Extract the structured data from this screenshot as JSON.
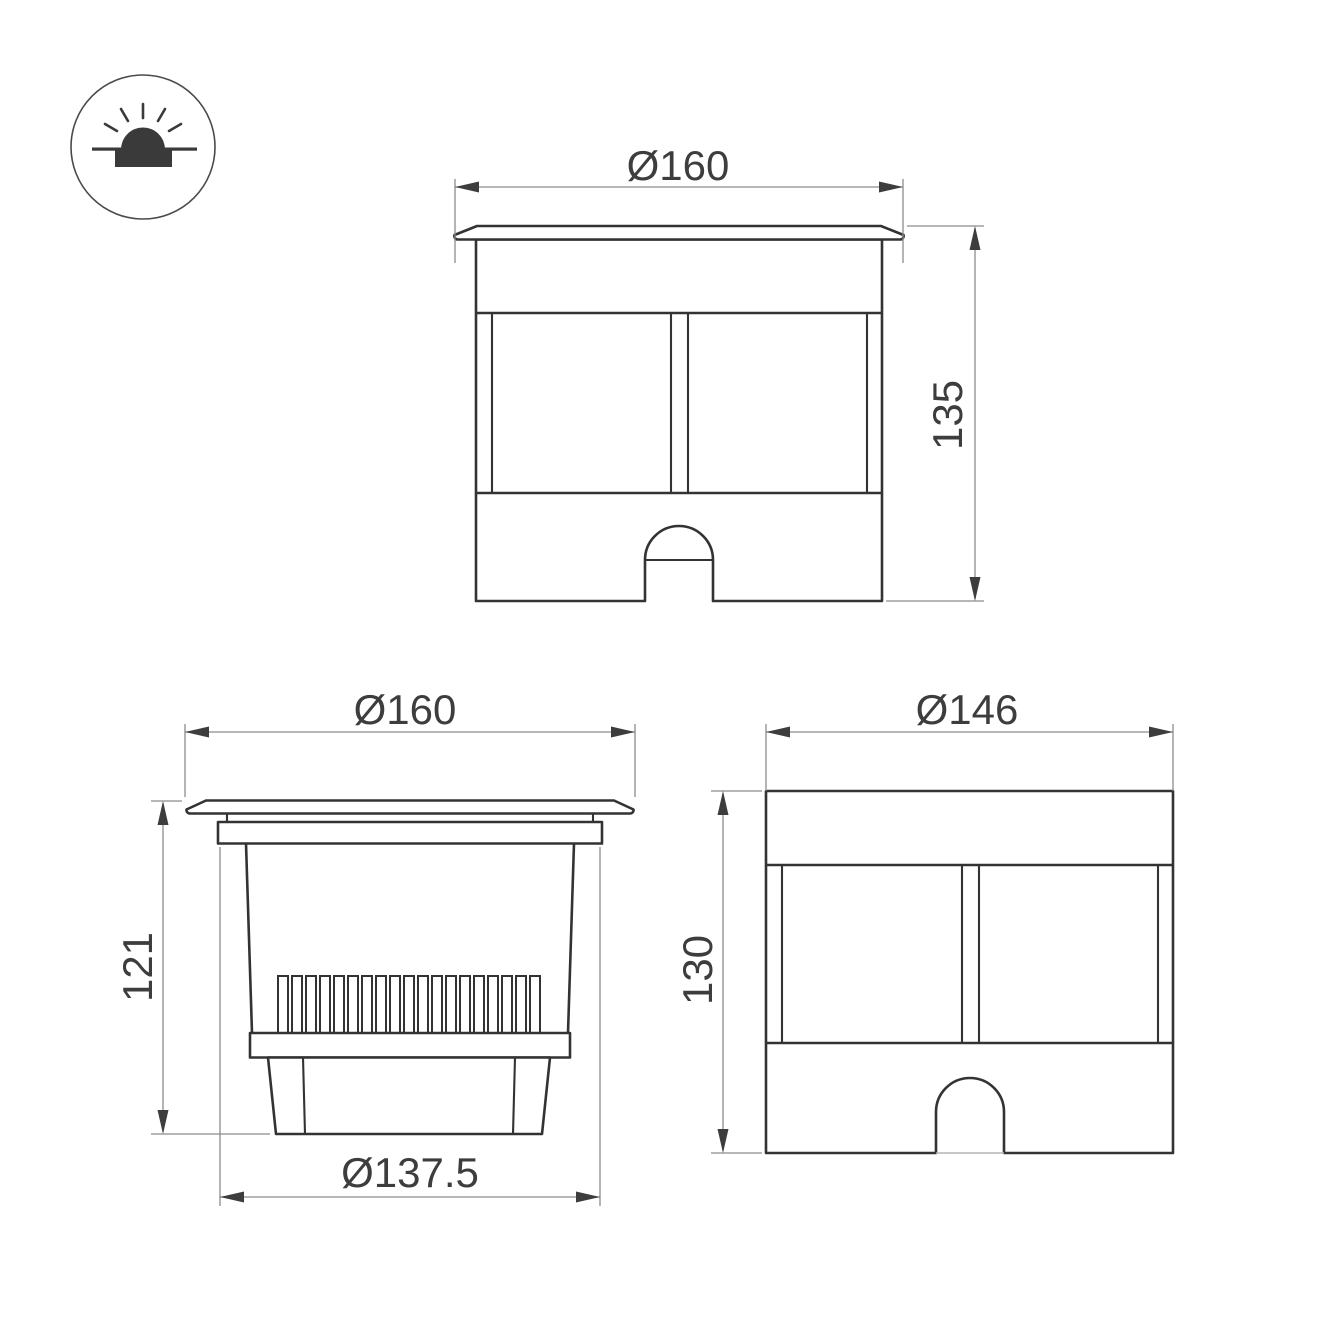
{
  "page": {
    "background": "#ffffff"
  },
  "colors": {
    "outline": "#333333",
    "dimension_line": "#8c8c8c",
    "arrowhead": "#3d3d3d",
    "label_text": "#3d3d3d"
  },
  "icon": {
    "name": "recessed-ground-luminaire-symbol"
  },
  "views": {
    "front_assembled": {
      "title": "front view - assembled fixture",
      "diameter_label": "Ø160",
      "height_label": "135"
    },
    "side_unit": {
      "title": "side view - light unit with heatsink",
      "diameter_label": "Ø160",
      "height_label": "121",
      "base_diameter_label": "Ø137.5"
    },
    "mounting_sleeve": {
      "title": "front view - mounting sleeve",
      "diameter_label": "Ø146",
      "height_label": "130"
    }
  }
}
